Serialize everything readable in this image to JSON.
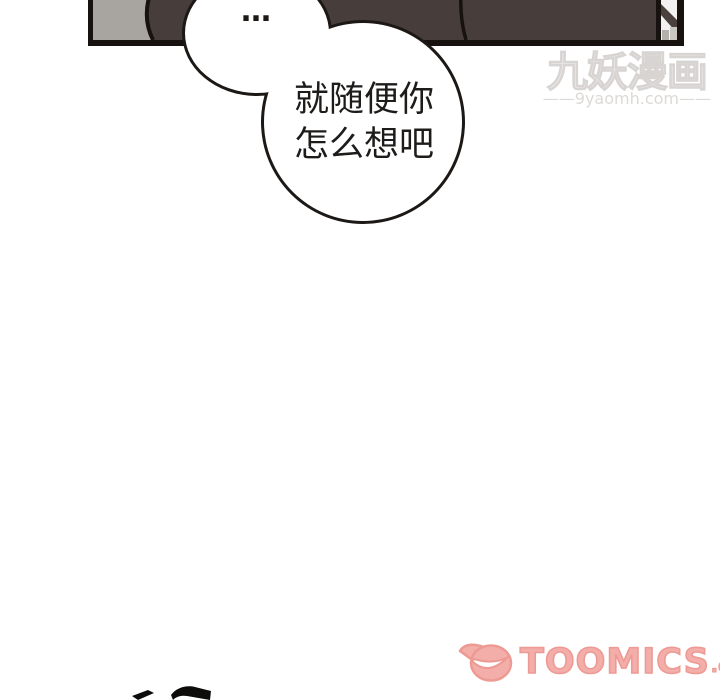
{
  "page": {
    "type": "webtoon-comic-page",
    "background": "#ffffff"
  },
  "panel": {
    "description": "top-cropped dark interior comic panel",
    "colors": {
      "interior": "#473d3a",
      "border": "#17120f",
      "wall_gray": "#a8a5a1",
      "doorway_white": "#f3f1ef",
      "doorway_shadow": "#4a403c"
    }
  },
  "speech": {
    "small_bubble": {
      "text": "…"
    },
    "large_bubble": {
      "line1": "就随便你",
      "line2": "怎么想吧"
    }
  },
  "watermarks": {
    "site": {
      "title": "九妖漫画",
      "url": "——9yaomh.com——",
      "color": "#e9e7e6"
    },
    "publisher": {
      "name": "TOOMICS",
      "suffix": ".com",
      "fill": "#f3aeaa",
      "outline": "#ee9a94",
      "icon": "toomics-mascot-grin"
    }
  }
}
